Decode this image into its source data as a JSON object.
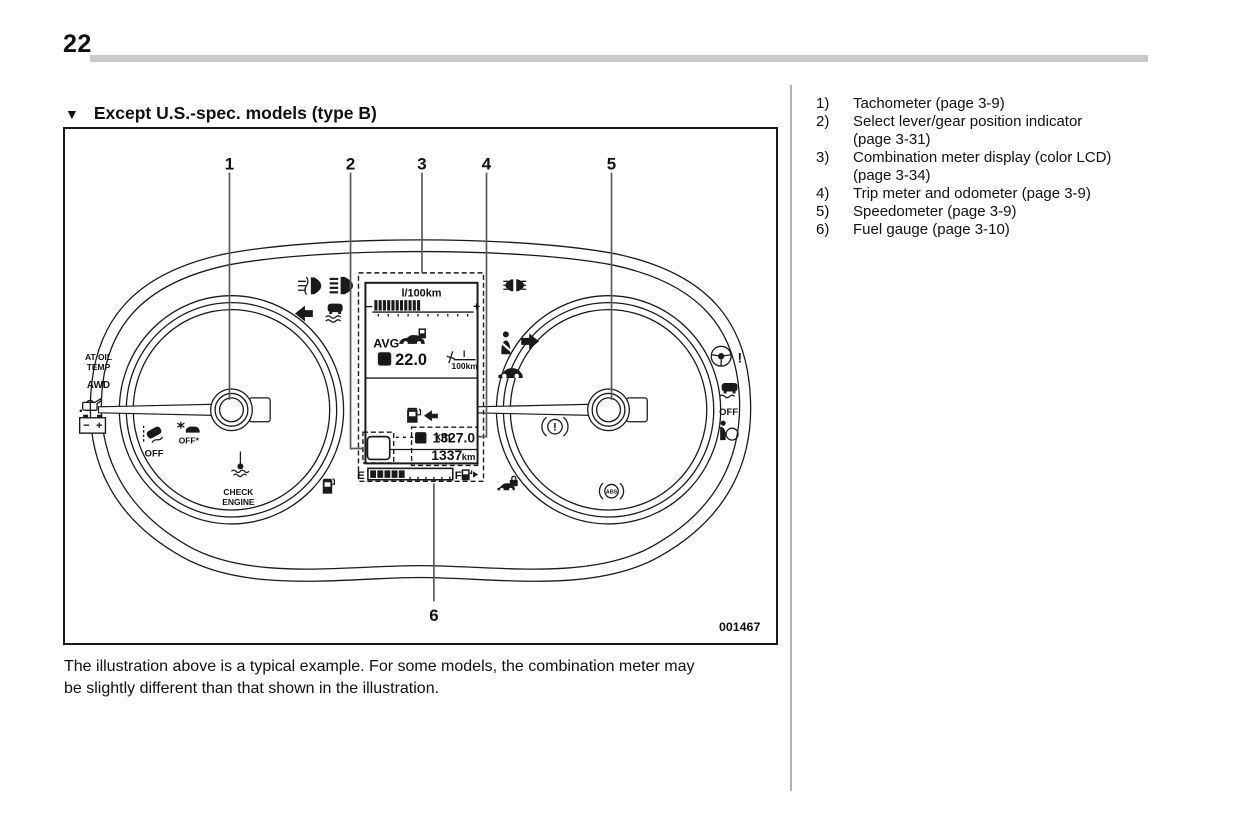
{
  "header": {
    "page_number": "22",
    "section_marker": "▼",
    "section_title": "Except U.S.-spec. models (type B)"
  },
  "figure": {
    "code": "001467",
    "callouts": {
      "c1": "1",
      "c2": "2",
      "c3": "3",
      "c4": "4",
      "c5": "5",
      "c6": "6"
    },
    "lcd": {
      "economy_unit": "l/100km",
      "bar_minus": "−",
      "bar_plus": "+",
      "avg_label": "AVG",
      "trip_selector": "B",
      "avg_value": "22.0",
      "avg_unit_numerator": "l",
      "avg_unit_denominator": "100km",
      "range_value": "- - - -",
      "range_unit": "km",
      "odo_selector": "B",
      "trip_value": "1327.0",
      "odo_value": "1337",
      "odo_unit": "km",
      "fuel_empty": "E",
      "fuel_full": "F"
    },
    "indicator_labels": {
      "at_oil_line1": "AT OIL",
      "at_oil_line2": "TEMP",
      "awd": "AWD",
      "vdc_off": "OFF",
      "precollision_off": "OFF*",
      "check_line1": "CHECK",
      "check_line2": "ENGINE",
      "traction_off": "OFF",
      "abs": "ABS",
      "brake_warning_mark": "!",
      "steering_warning_mark": "!"
    },
    "icon_names": [
      "fog-light-icon",
      "high-beam-icon",
      "turn-left-icon",
      "traction-control-icon",
      "tail-light-icon",
      "seatbelt-icon",
      "turn-right-icon",
      "car-slip-icon",
      "oil-pressure-icon",
      "battery-icon",
      "vdc-off-icon",
      "precollision-off-icon",
      "coolant-temp-icon",
      "fuel-pump-icon",
      "steering-warning-icon",
      "traction-off-icon",
      "airbag-icon",
      "brake-warning-icon",
      "security-icon",
      "abs-icon"
    ]
  },
  "legend": {
    "items": [
      {
        "num": "1)",
        "line1": "Tachometer (page 3-9)"
      },
      {
        "num": "2)",
        "line1": "Select lever/gear position indicator",
        "line2": "(page 3-31)"
      },
      {
        "num": "3)",
        "line1": "Combination meter display (color LCD)",
        "line2": "(page 3-34)"
      },
      {
        "num": "4)",
        "line1": "Trip meter and odometer (page 3-9)"
      },
      {
        "num": "5)",
        "line1": "Speedometer (page 3-9)"
      },
      {
        "num": "6)",
        "line1": "Fuel gauge (page 3-10)"
      }
    ]
  },
  "caption": {
    "line1": "The illustration above is a typical example. For some models, the combination meter may",
    "line2": "be slightly different than that shown in the illustration."
  }
}
